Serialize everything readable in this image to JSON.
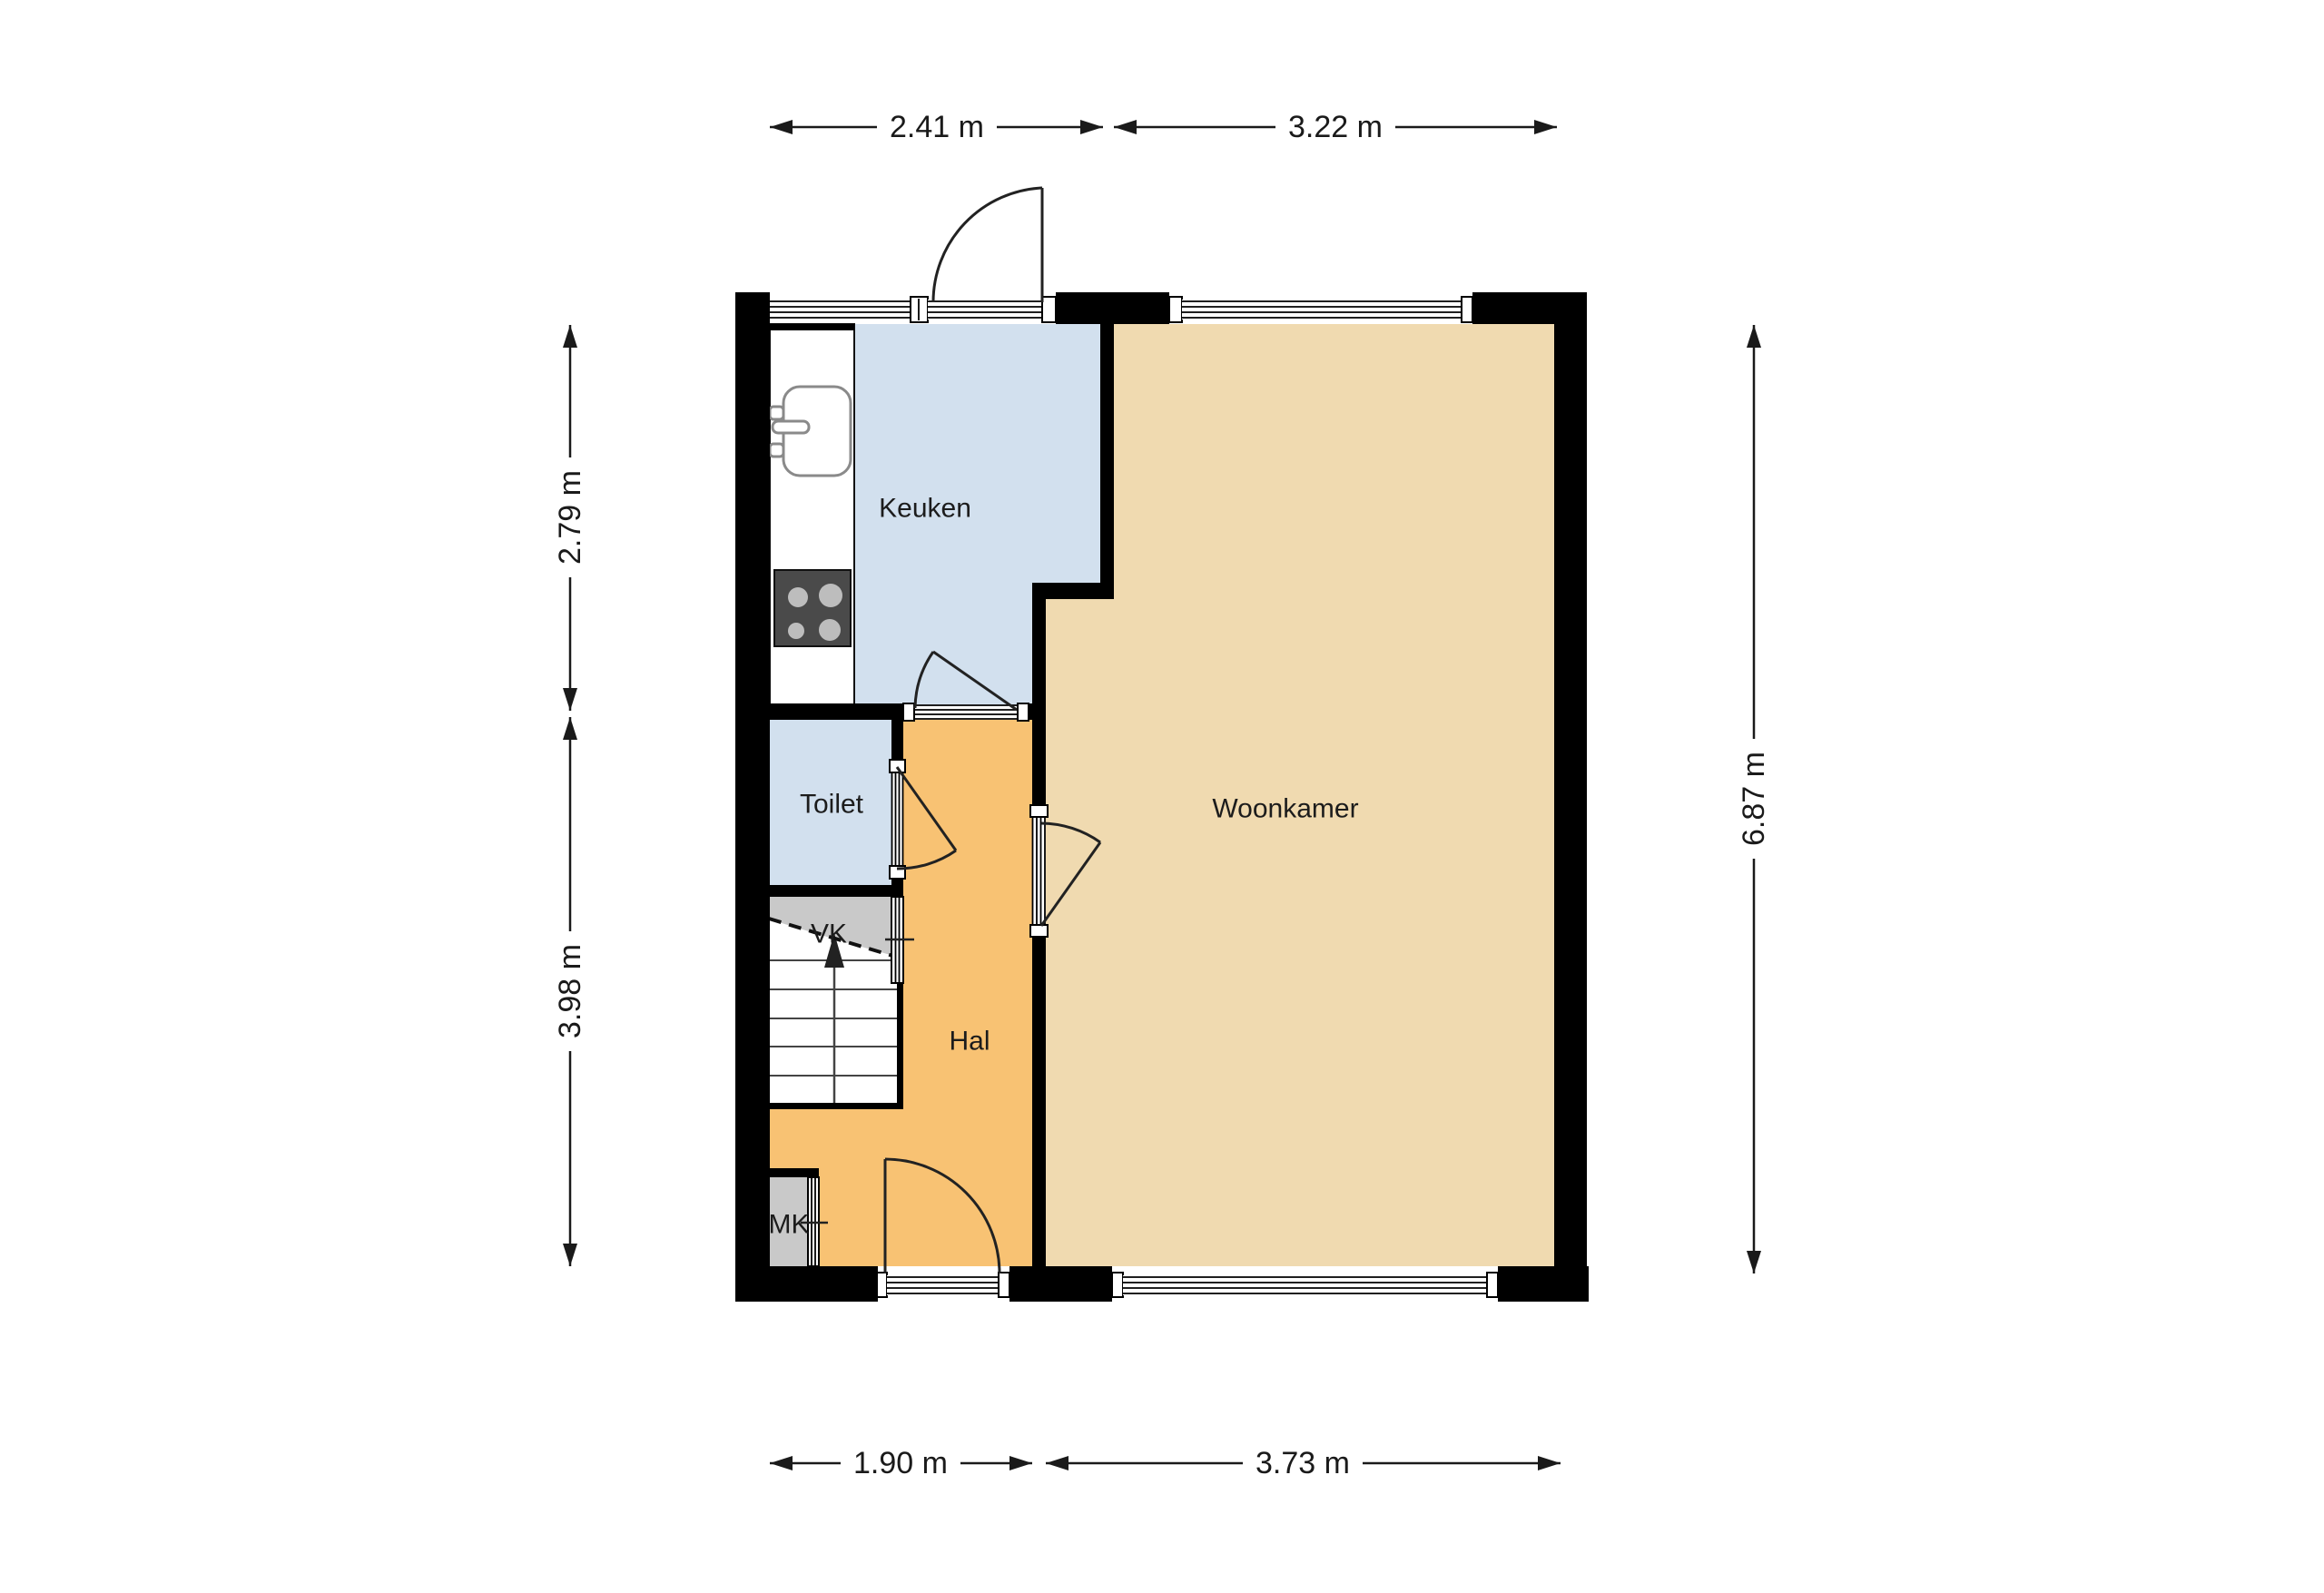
{
  "floorplan": {
    "rooms": [
      {
        "key": "keuken",
        "label": "Keuken"
      },
      {
        "key": "toilet",
        "label": "Toilet"
      },
      {
        "key": "hal",
        "label": "Hal"
      },
      {
        "key": "woonkamer",
        "label": "Woonkamer"
      },
      {
        "key": "vk",
        "label": "VK"
      },
      {
        "key": "mk",
        "label": "MK"
      }
    ],
    "dimensions": {
      "top": [
        {
          "label": "2.41 m"
        },
        {
          "label": "3.22 m"
        }
      ],
      "bottom": [
        {
          "label": "1.90 m"
        },
        {
          "label": "3.73 m"
        }
      ],
      "left": [
        {
          "label": "2.79 m"
        },
        {
          "label": "3.98 m"
        }
      ],
      "right": [
        {
          "label": "6.87 m"
        }
      ]
    },
    "colors": {
      "wall": "#000000",
      "room_keuken": "#d2e0ee",
      "room_toilet": "#d2e0ee",
      "room_hal": "#f8c273",
      "room_woonkamer": "#f0dab0",
      "closet": "#c9c9c9",
      "stove": "#4a4a4a",
      "burner": "#bdbdbd"
    }
  }
}
